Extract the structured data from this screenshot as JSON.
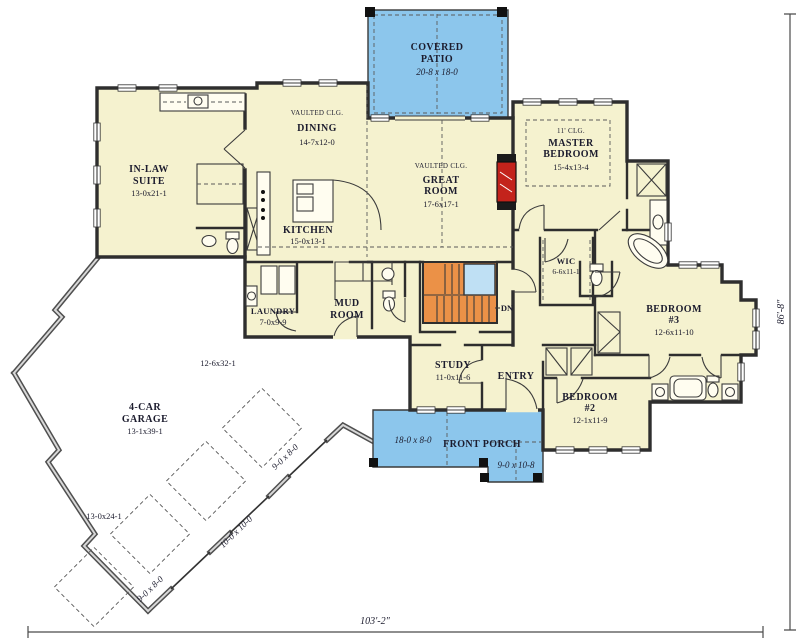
{
  "plan": {
    "colors": {
      "floor": "#F5F2CF",
      "patio_blue": "#8CC6EC",
      "stair_orange": "#EB9147",
      "stair_window_blue": "#BFE0F4",
      "fireplace_red": "#C3231B",
      "wall": "#2E2E2E"
    },
    "rooms": {
      "covered_patio": {
        "lines": [
          "COVERED",
          "PATIO",
          "20-8 x 18-0"
        ]
      },
      "dining": {
        "lines": [
          "VAULTED CLG.",
          "DINING",
          "14-7x12-0"
        ]
      },
      "great_room": {
        "lines": [
          "VAULTED CLG.",
          "GREAT",
          "ROOM",
          "17-6x17-1"
        ]
      },
      "in_law_suite": {
        "lines": [
          "IN-LAW",
          "SUITE",
          "13-0x21-1"
        ]
      },
      "master_bedroom": {
        "lines": [
          "11' CLG.",
          "MASTER",
          "BEDROOM",
          "15-4x13-4"
        ]
      },
      "kitchen": {
        "lines": [
          "KITCHEN",
          "15-0x13-1"
        ]
      },
      "wic": {
        "lines": [
          "WIC",
          "6-6x11-1"
        ]
      },
      "laundry": {
        "lines": [
          "LAUNDRY",
          "7-0x9-9"
        ]
      },
      "mud_room": {
        "lines": [
          "MUD",
          "ROOM"
        ]
      },
      "study": {
        "lines": [
          "STUDY",
          "11-0x11-6"
        ]
      },
      "entry": {
        "lines": [
          "ENTRY"
        ]
      },
      "bedroom_2": {
        "lines": [
          "BEDROOM",
          "#2",
          "12-1x11-9"
        ]
      },
      "bedroom_3": {
        "lines": [
          "BEDROOM",
          "#3",
          "12-6x11-10"
        ]
      },
      "front_porch": {
        "label": "FRONT PORCH",
        "dim_left": "18-0 x 8-0",
        "dim_right": "9-0 x 10-8"
      },
      "garage": {
        "lines": [
          "4-CAR",
          "GARAGE",
          "13-1x39-1"
        ],
        "dim_interior": "12-6x32-1",
        "dim_side": "13-0x24-1",
        "door_labels": [
          "9-0 x 8-0",
          "10-0 x 10-0",
          "9-0 x 8-0"
        ]
      }
    },
    "stairs": {
      "label": "DN"
    },
    "overall_dimensions": {
      "width": "103'-2\"",
      "depth": "86'-8\""
    }
  }
}
